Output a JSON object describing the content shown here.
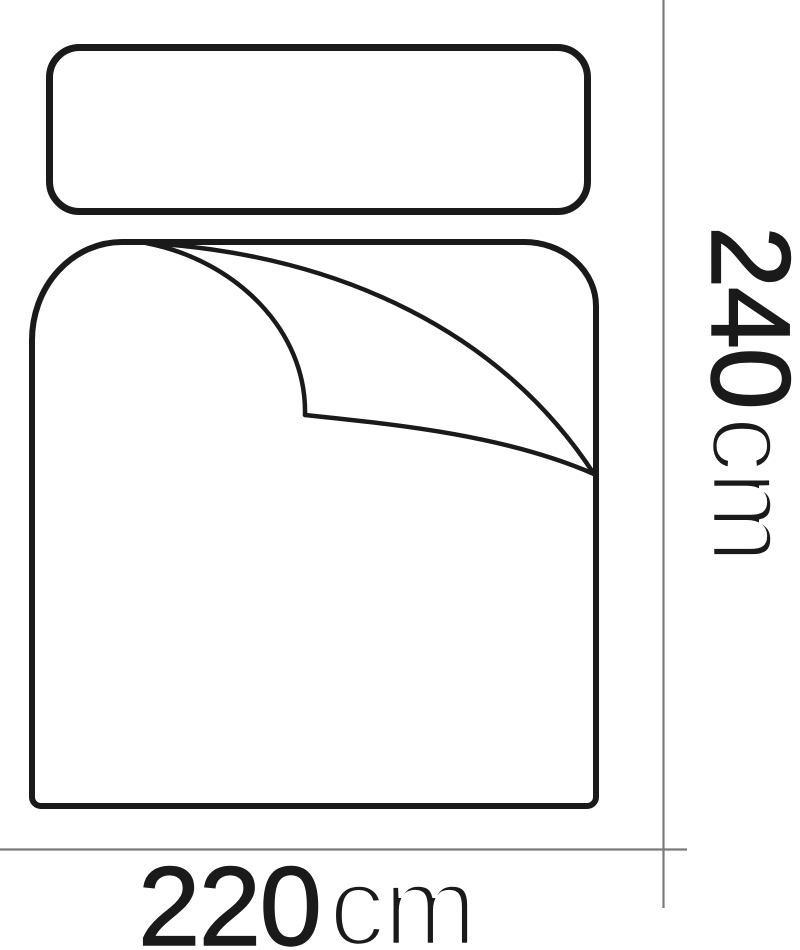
{
  "diagram": {
    "subject": "duvet-and-pillow-dimension-diagram",
    "colors": {
      "outline": "#1a1a1a",
      "dimension_line": "#7a7a7a",
      "label_text": "#1a1a1a",
      "background": "#ffffff"
    }
  },
  "labels": {
    "width": {
      "number": "220",
      "unit": "cm",
      "text": "220cm",
      "orientation": "horizontal"
    },
    "height": {
      "number": "240",
      "unit": "cm",
      "text": "240cm",
      "orientation": "vertical"
    }
  }
}
